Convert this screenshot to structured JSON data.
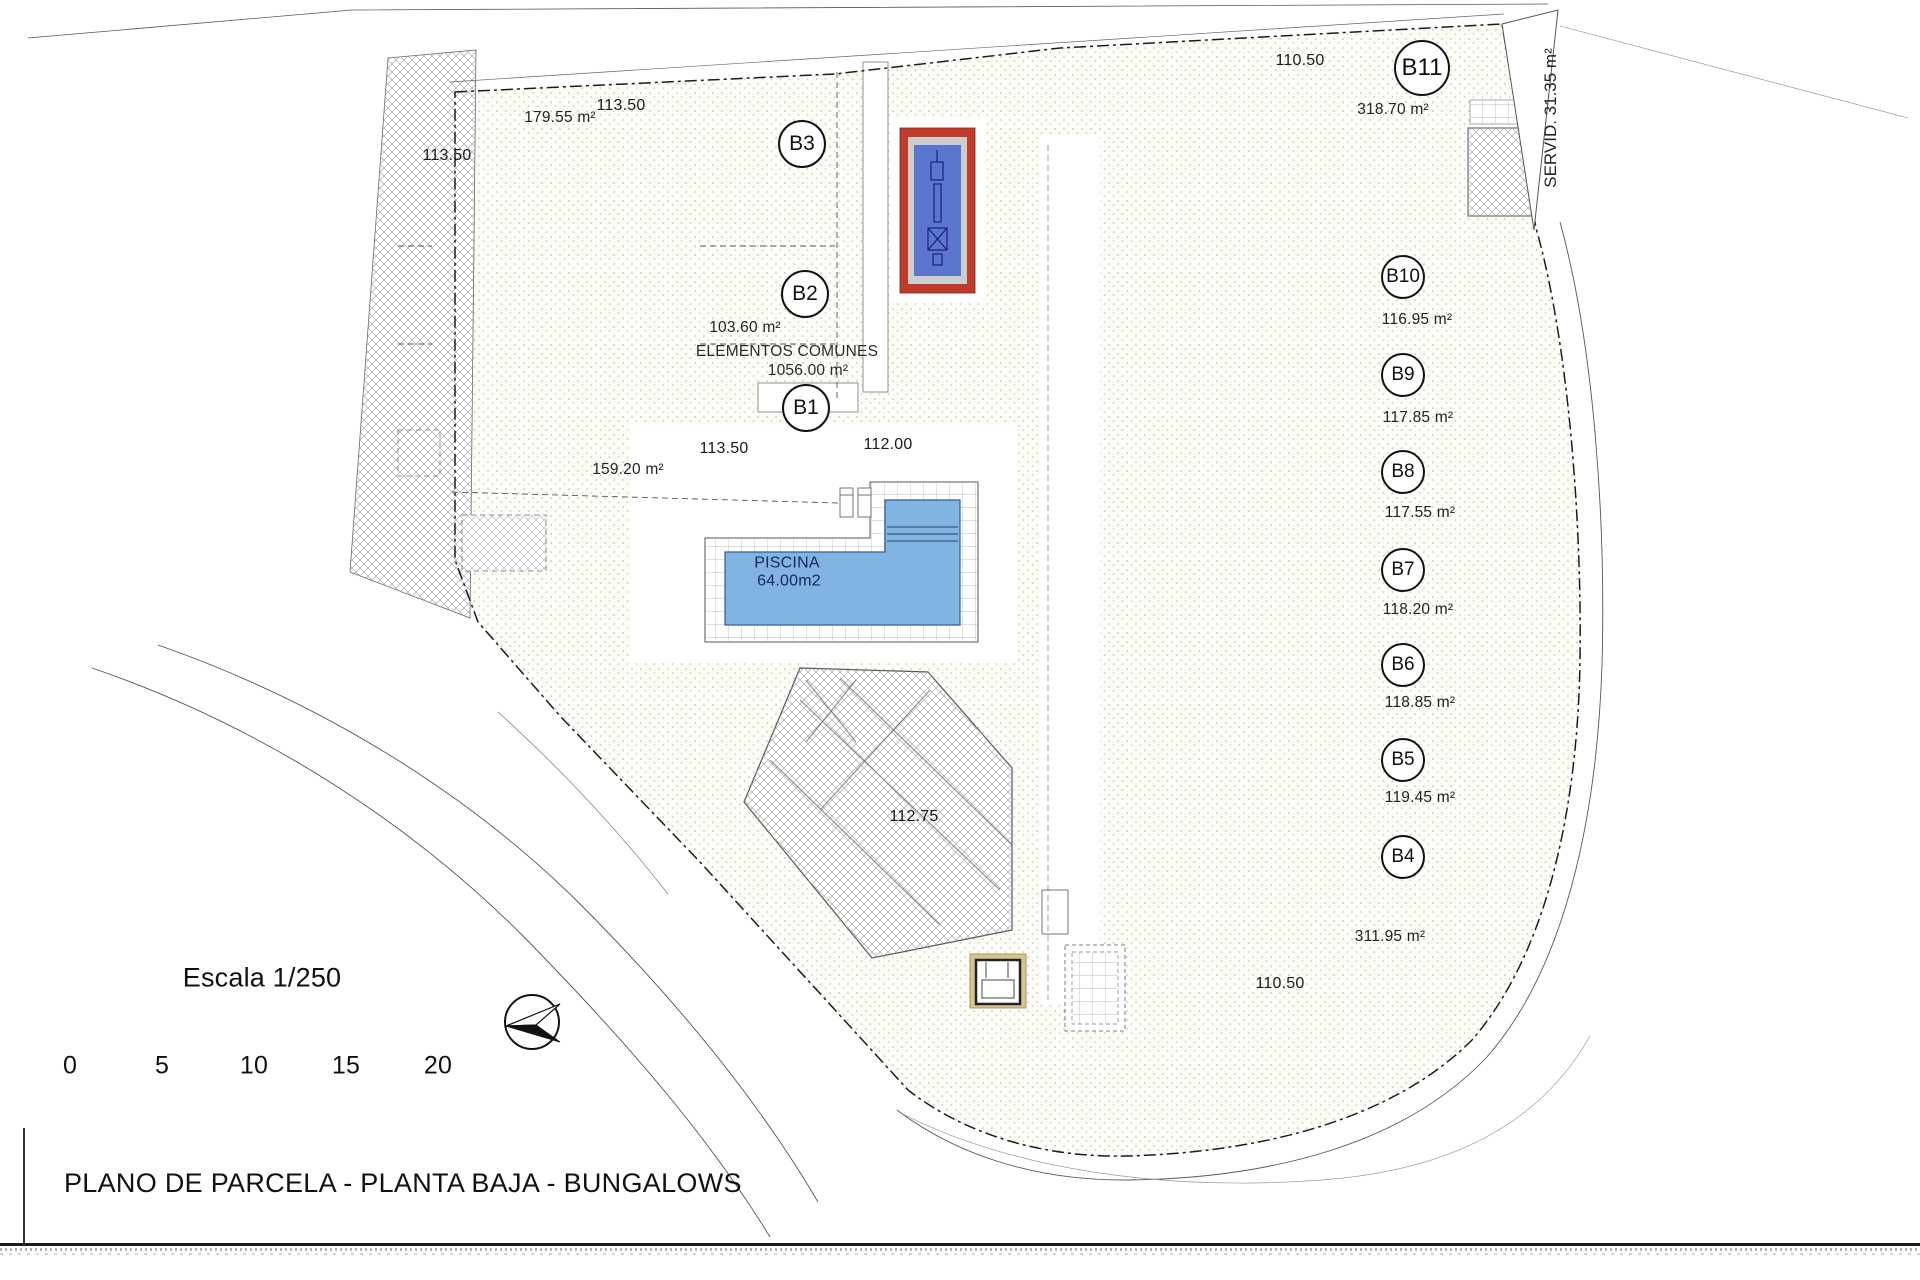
{
  "sheet": {
    "title": "PLANO DE PARCELA - PLANTA BAJA - BUNGALOWS"
  },
  "scalebar": {
    "label": "Escala 1/250",
    "ticks": [
      "0",
      "5",
      "10",
      "15",
      "20"
    ]
  },
  "icons": {
    "north_arrow": "north-arrow-icon",
    "palm_tree": "palm-tree-icon",
    "hedge_bush": "hedge-bush-icon"
  },
  "common_elements": {
    "label": "ELEMENTOS COMUNES",
    "area": "1056.00 m²"
  },
  "pool": {
    "label": "PISCINA",
    "area": "64.00m2"
  },
  "servitude": {
    "label": "SERVID. 31.35 m²"
  },
  "units": [
    {
      "id": "B1",
      "area": "159.20 m²"
    },
    {
      "id": "B2",
      "area": "103.60 m²"
    },
    {
      "id": "B3",
      "area": "179.55 m²"
    },
    {
      "id": "B4",
      "area": "311.95 m²"
    },
    {
      "id": "B5",
      "area": "119.45 m²"
    },
    {
      "id": "B6",
      "area": "118.85 m²"
    },
    {
      "id": "B7",
      "area": "118.20 m²"
    },
    {
      "id": "B8",
      "area": "117.55 m²"
    },
    {
      "id": "B9",
      "area": "117.85 m²"
    },
    {
      "id": "B10",
      "area": "116.95 m²"
    },
    {
      "id": "B11",
      "area": "318.70 m²"
    }
  ],
  "levels": [
    {
      "value": "113.50"
    },
    {
      "value": "113.50"
    },
    {
      "value": "113.50"
    },
    {
      "value": "112.00"
    },
    {
      "value": "112.75"
    },
    {
      "value": "110.50"
    },
    {
      "value": "110.50"
    }
  ],
  "colors": {
    "pool_water": "#82b4e2",
    "court_red": "#bf3b2c",
    "court_blue": "#5b76cf",
    "vegetation_green": "#76b82a",
    "hedge_green": "#7da428",
    "fence_tan": "#d9c491"
  }
}
